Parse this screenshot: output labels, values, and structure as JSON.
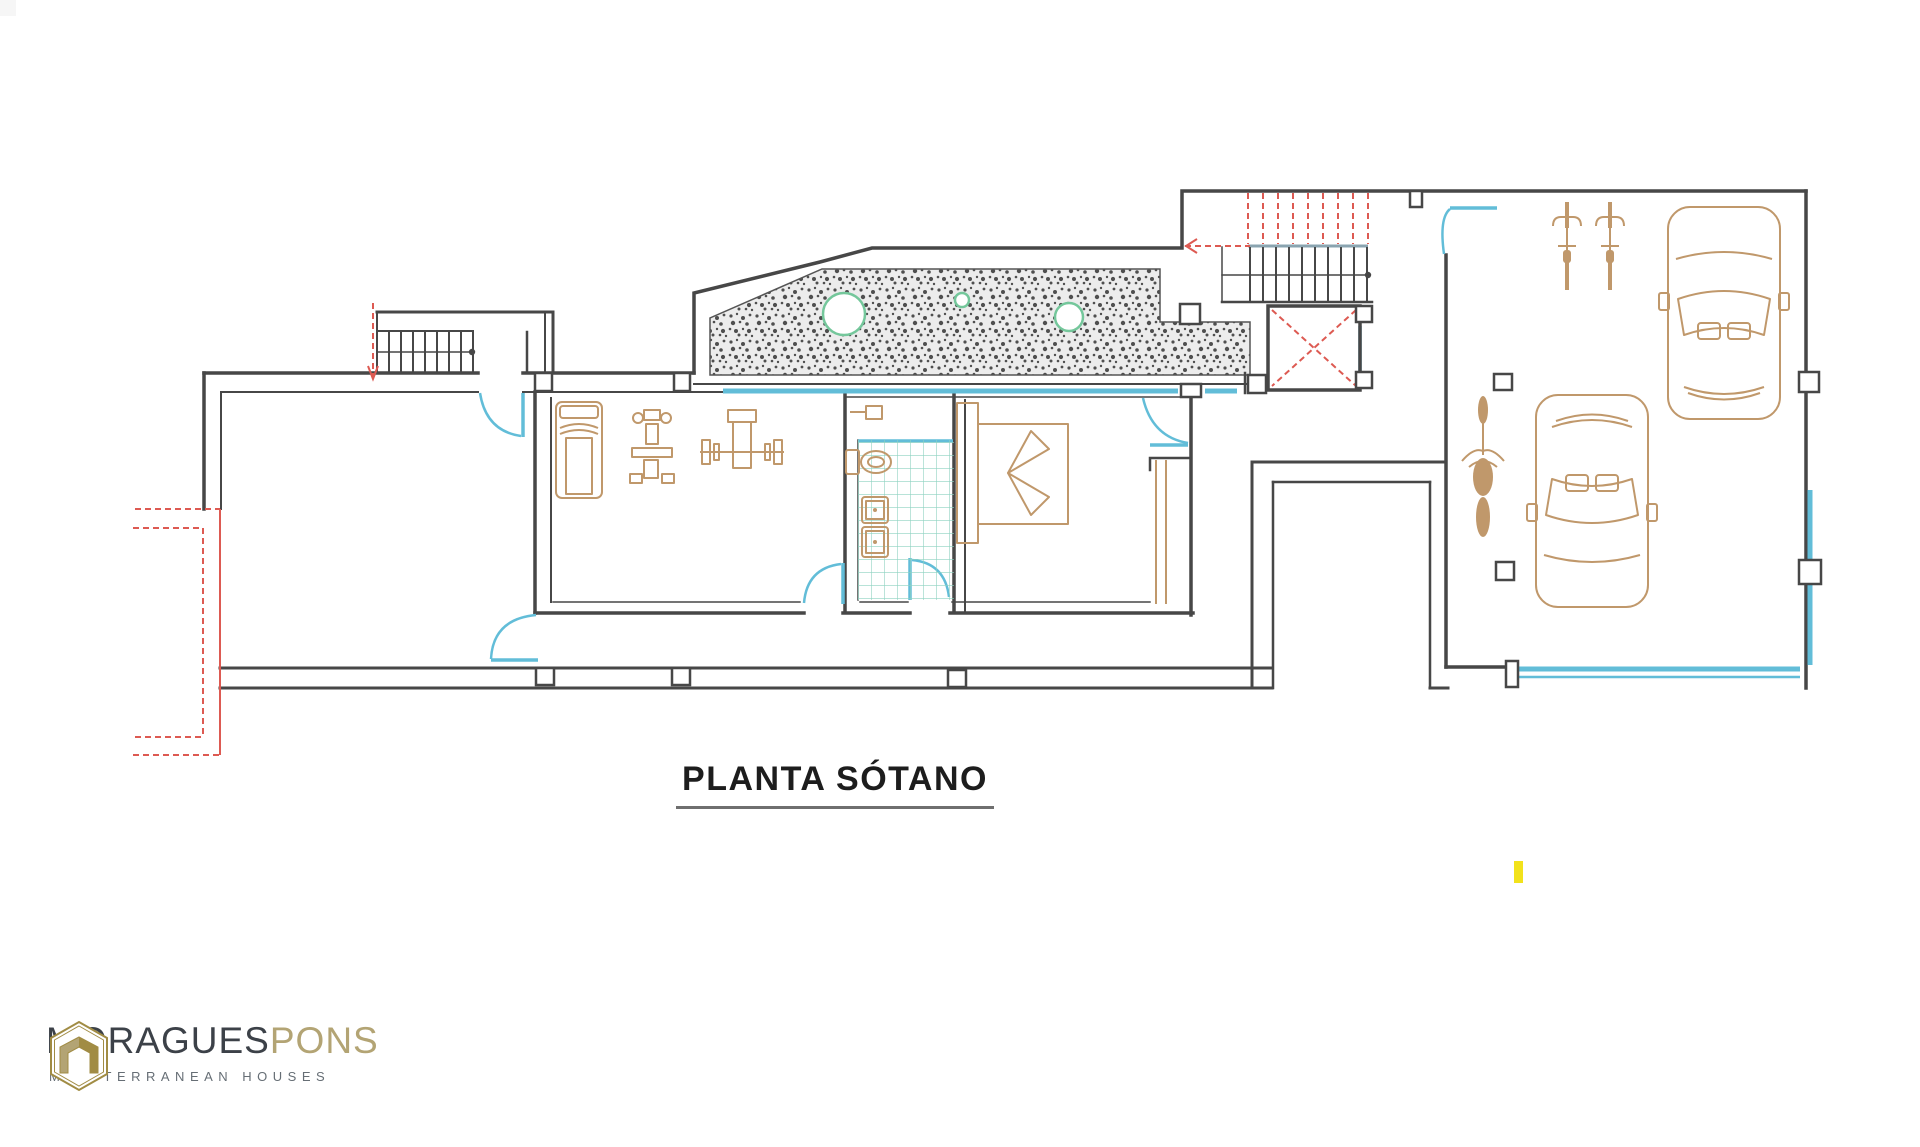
{
  "page": {
    "background": "#ffffff"
  },
  "title": {
    "text": "PLANTA SÓTANO"
  },
  "logo": {
    "brand_primary": "MORAGUES",
    "brand_secondary": "PONS",
    "tagline": "MEDITERRANEAN HOUSES",
    "icon": "hexagon-house-icon"
  },
  "colors": {
    "wall": "#474747",
    "door_window": "#62bdd8",
    "stairs_accent": "#dd5a52",
    "furniture": "#c0986b",
    "tile": "#8ed2c0",
    "vegetation": "#74c79b",
    "stipple_fill": "#ececec",
    "stipple_dot": "#4f4f4f",
    "highlight": "#f2e21b",
    "underline": "#6f6f6f",
    "brand_gold": "#a18c44",
    "brand_gold_light": "#b3a474",
    "brand_dark": "#3c4148",
    "brand_tagline": "#666e75"
  },
  "floorplan": {
    "drawing_label": "basement floor plan",
    "features": [
      "entry-stairs",
      "main-room",
      "access-ramp",
      "gym-room",
      "bathroom",
      "bedroom",
      "hallway",
      "interior-staircase",
      "elevator",
      "terrain-section",
      "light-well",
      "garage"
    ],
    "furniture_icons": [
      "treadmill-icon",
      "exercise-machine-icon",
      "bench-press-icon",
      "toilet-paper-icon",
      "toilet-icon",
      "sink-icon",
      "sink-icon",
      "double-bed-icon",
      "wardrobe-icon",
      "bicycle-icon",
      "bicycle-icon",
      "motorcycle-icon",
      "car-icon",
      "car-icon"
    ],
    "highlight_marker": {
      "x": 1514,
      "y": 861
    }
  }
}
